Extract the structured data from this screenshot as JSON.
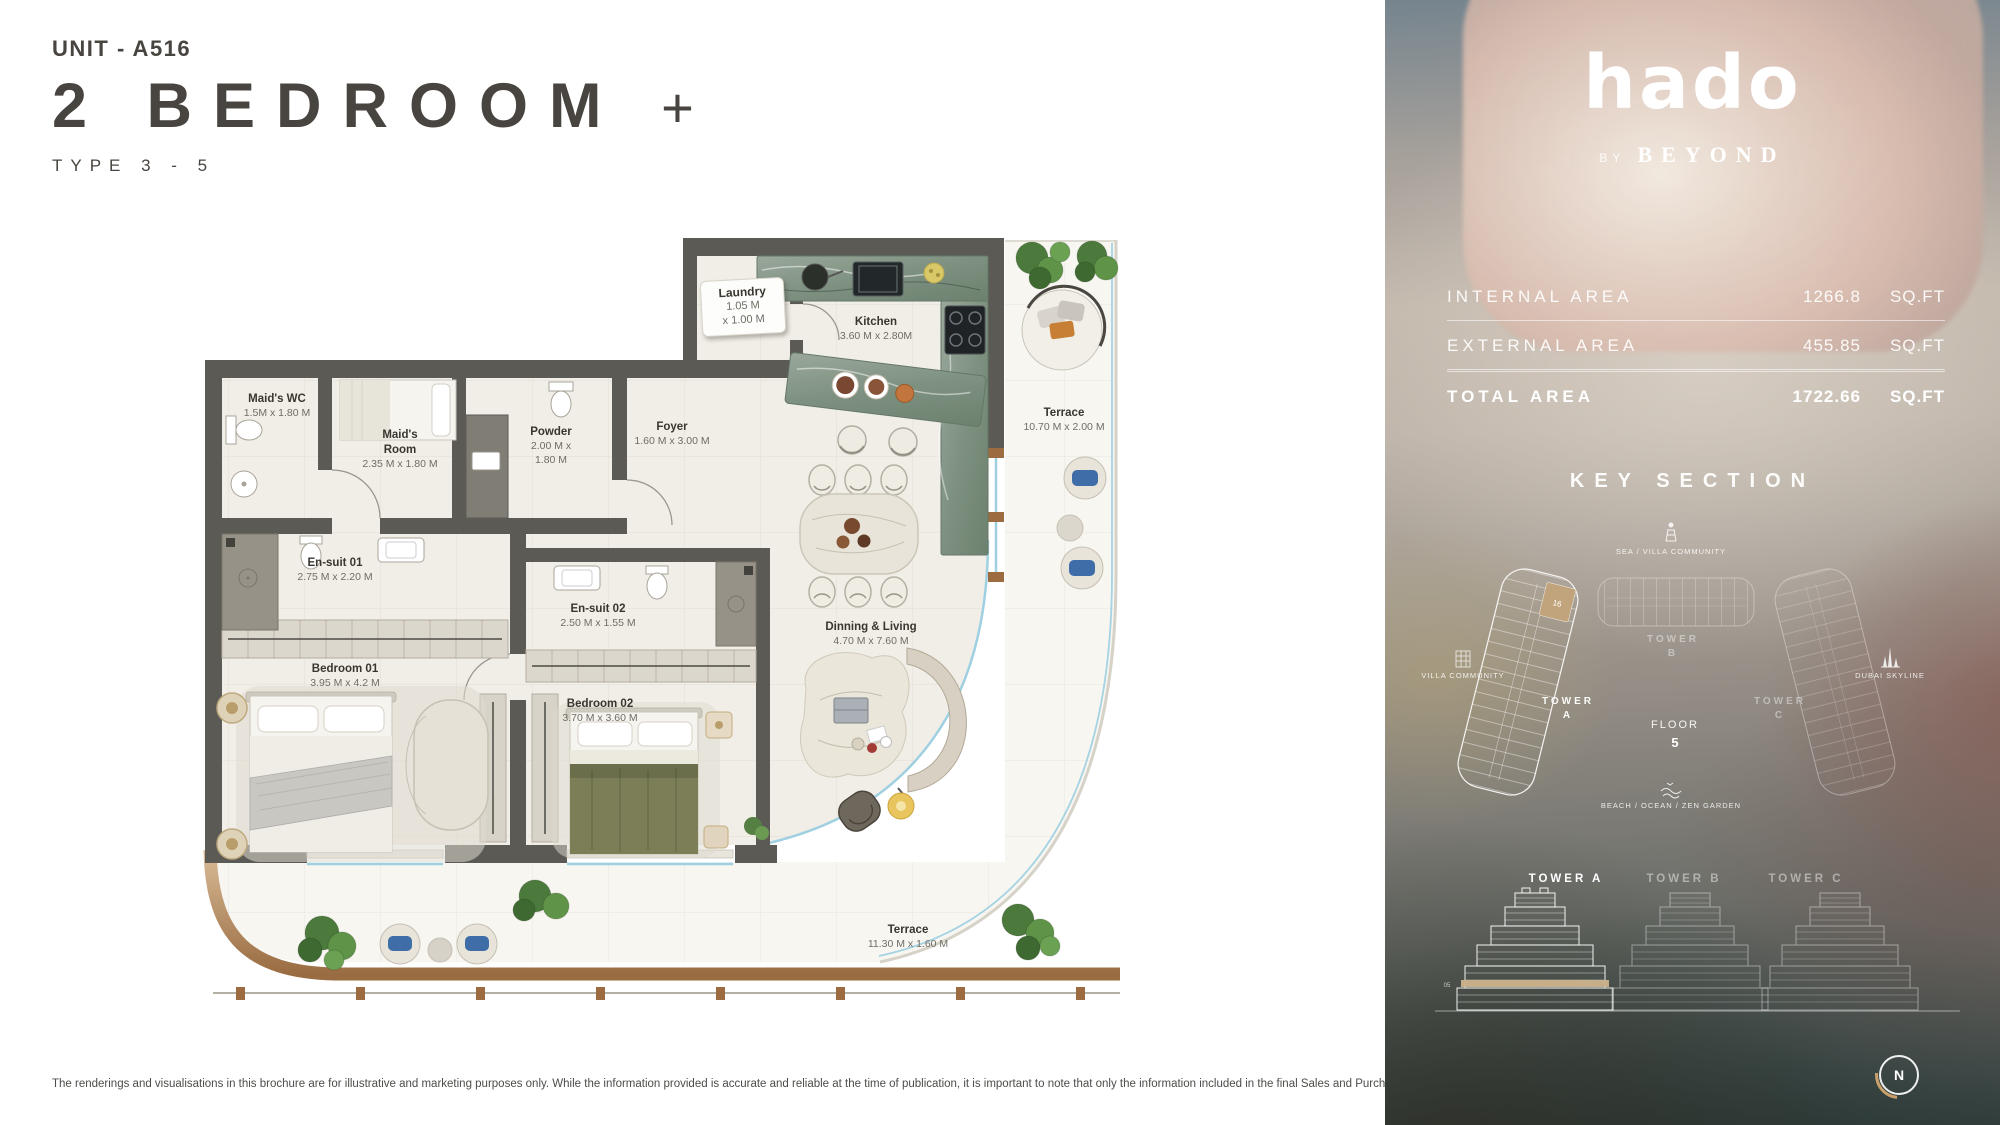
{
  "page": {
    "unit_label": "UNIT - A516",
    "title": "2 BEDROOM",
    "title_suffix": "+",
    "type_label": "TYPE 3 - 5",
    "disclaimer": "The renderings and visualisations in this brochure are for illustrative and marketing purposes only. While the information provided is accurate and reliable at the time of publication, it is important to note that only the information included in the final Sales and Purchase Agreement will carry legal significance."
  },
  "floorplan": {
    "rooms": [
      {
        "name": "Laundry",
        "dims": "1.05 M",
        "dims2": "x 1.00 M"
      },
      {
        "name": "Kitchen",
        "dims": "3.60 M x 2.80M"
      },
      {
        "name": "Maid's WC",
        "dims": "1.5M x 1.80 M"
      },
      {
        "name": "Maid's Room",
        "dims": "2.35 M x 1.80 M"
      },
      {
        "name": "Powder",
        "dims": "2.00 M x 1.80 M"
      },
      {
        "name": "Foyer",
        "dims": "1.60 M x 3.00 M"
      },
      {
        "name": "En-suit 01",
        "dims": "2.75 M x 2.20 M"
      },
      {
        "name": "En-suit 02",
        "dims": "2.50 M x 1.55 M"
      },
      {
        "name": "Bedroom 01",
        "dims": "3.95 M x 4.2 M"
      },
      {
        "name": "Bedroom 02",
        "dims": "3.70 M x 3.60 M"
      },
      {
        "name": "Dinning & Living",
        "dims": "4.70 M x 7.60 M"
      },
      {
        "name": "Terrace",
        "dims": "10.70 M x 2.00 M"
      },
      {
        "name": "Terrace",
        "dims": "11.30 M x 1.60 M"
      }
    ],
    "colors": {
      "wall": "#5c5a55",
      "floor": "#f1eee7",
      "terrace": "#f7f6f1",
      "glass": "#9fd0e2",
      "bronze": "#b68a5e"
    }
  },
  "sidebar": {
    "brand": {
      "logo": "hado",
      "by": "BY",
      "name": "BEYOND"
    },
    "areas": {
      "internal": {
        "label": "INTERNAL AREA",
        "value": "1266.8",
        "unit": "SQ.FT"
      },
      "external": {
        "label": "EXTERNAL AREA",
        "value": "455.85",
        "unit": "SQ.FT"
      },
      "total": {
        "label": "TOTAL AREA",
        "value": "1722.66",
        "unit": "SQ.FT"
      }
    },
    "key_section": {
      "title": "KEY SECTION",
      "sea_label": "SEA / VILLA COMMUNITY",
      "villa_label": "VILLA COMMUNITY",
      "dubai_label": "DUBAI SKYLINE",
      "beach_label": "BEACH / OCEAN / ZEN GARDEN",
      "tower_word": "TOWER",
      "tower_a": "A",
      "tower_b": "B",
      "tower_c": "C",
      "floor_label": "FLOOR",
      "floor_value": "5",
      "unit_number": "16",
      "floor_band": "05"
    },
    "elevations": {
      "tower_a": "TOWER A",
      "tower_b": "TOWER B",
      "tower_c": "TOWER C"
    },
    "compass": {
      "n": "N"
    }
  }
}
